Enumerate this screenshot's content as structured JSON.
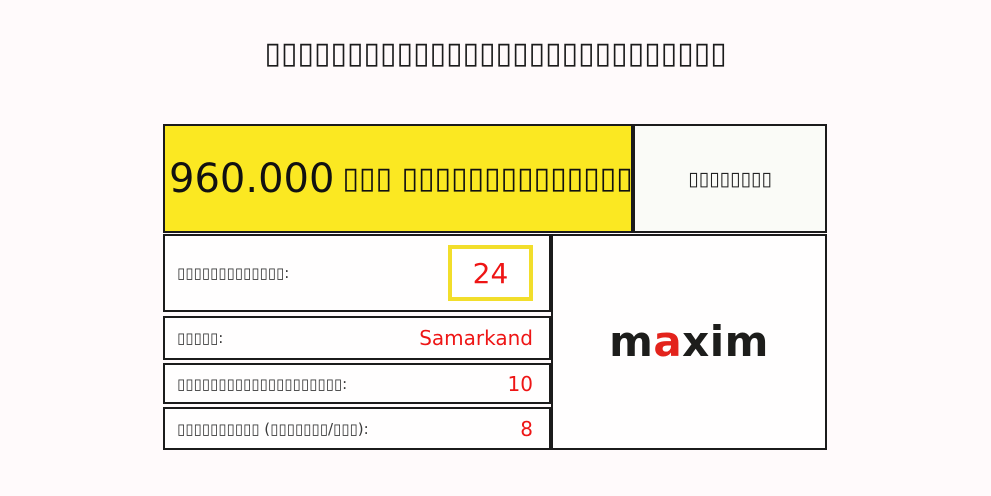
{
  "page": {
    "title": "▯▯▯▯▯▯▯▯▯▯▯▯▯▯▯▯▯▯▯▯▯▯▯▯▯▯▯▯"
  },
  "card": {
    "header": {
      "amount": "960.000",
      "caption": "▯▯▯ ▯▯▯▯▯▯▯▯▯▯▯▯▯▯▯",
      "side_label": "▯▯▯▯▯▯▯▯"
    },
    "rows": [
      {
        "label": "▯▯▯▯▯▯▯▯▯▯▯▯▯:",
        "value": "24"
      },
      {
        "label": "▯▯▯▯▯:",
        "value": "Samarkand"
      },
      {
        "label": "▯▯▯▯▯▯▯▯▯▯▯▯▯▯▯▯▯▯▯▯:",
        "value": "10"
      },
      {
        "label": "▯▯▯▯▯▯▯▯▯▯ (▯▯▯▯▯▯▯/▯▯▯):",
        "value": "8"
      }
    ],
    "logo": {
      "part1": "m",
      "part2": "a",
      "part3": "xim"
    }
  },
  "colors": {
    "page_background": "#FFFAFB",
    "header_yellow": "#FBE822",
    "value_red": "#EE1515",
    "logo_red": "#E3231C",
    "border_black": "#1B1B1B",
    "value_box_border_yellow": "#F2DE2B"
  }
}
